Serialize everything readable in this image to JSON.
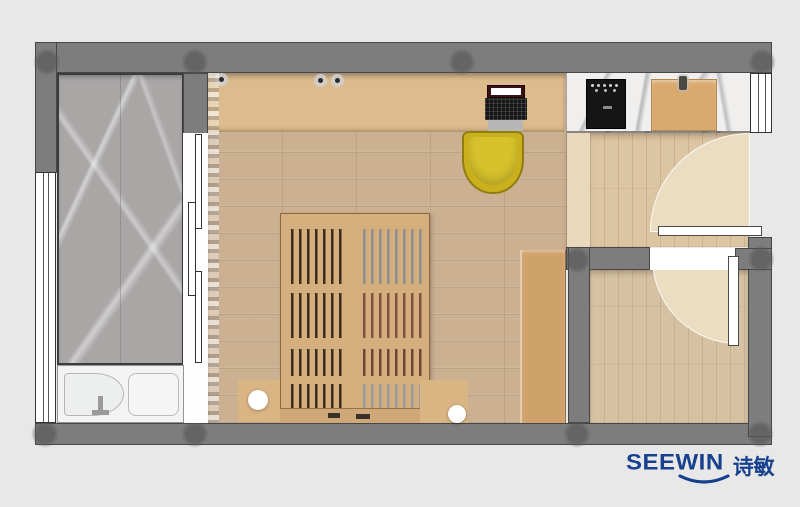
{
  "logo": {
    "brand": "SEEWIN",
    "cjk": "诗敏"
  },
  "colors": {
    "bg": "#e8e8e8",
    "wall": "#7d7d7d",
    "wall_border": "#474747",
    "marble_floor": "#a9a6a6",
    "counter_marble": "#f0efee",
    "wood_floor": "#cbb092",
    "desk_wood": "#dcbb8d",
    "hall_floor": "#e9d8bb",
    "entry_floor": "#dcc5a3",
    "room2_floor": "#d6c2a3",
    "swing_area": "#ecdcc2",
    "wardrobe": "#d0a26b",
    "bed_frame": "#d5ae7e",
    "bed_slat_dark": "#3c2b1b",
    "bed_slat_gray": "#8f8f8f",
    "bed_slat_red": "#82503f",
    "bench": "#cfa87a",
    "mat": "#d9b584",
    "chair": "#c9b01c",
    "chair_border": "#8f7d10",
    "chair_seat": "#d6c22c",
    "tub": "#f3f3f3",
    "door_leaf": "#ffffff",
    "cooktop": "#151515",
    "board": "#d9a96d",
    "logo_blue": "#17418f"
  }
}
